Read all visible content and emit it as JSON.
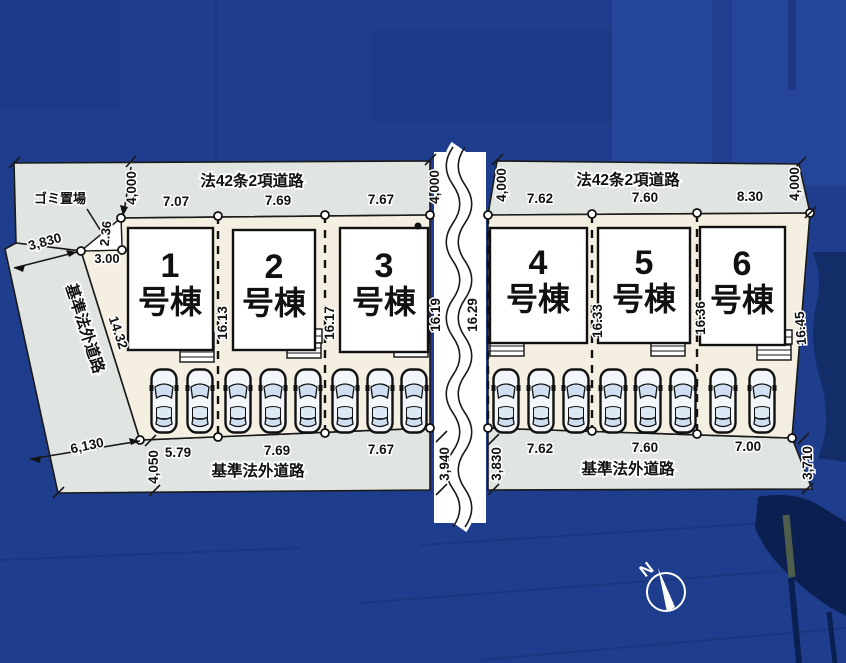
{
  "plan": {
    "roads": {
      "top_left": "法42条2項道路",
      "top_right": "法42条2項道路",
      "left": "基準法外道路",
      "bottom_left": "基準法外道路",
      "bottom_right": "基準法外道路"
    },
    "garbage": {
      "label": "ゴミ置場",
      "side_a": "2.36",
      "side_b": "3.00"
    },
    "lots": [
      {
        "no": "1",
        "suffix": "号棟",
        "top": "7.07",
        "bottom": "5.79"
      },
      {
        "no": "2",
        "suffix": "号棟",
        "top": "7.69",
        "bottom": "7.69"
      },
      {
        "no": "3",
        "suffix": "号棟",
        "top": "7.67",
        "bottom": "7.67"
      },
      {
        "no": "4",
        "suffix": "号棟",
        "top": "7.62",
        "bottom": "7.62"
      },
      {
        "no": "5",
        "suffix": "号棟",
        "top": "7.60",
        "bottom": "7.60"
      },
      {
        "no": "6",
        "suffix": "号棟",
        "top": "8.30",
        "bottom": "7.00"
      }
    ],
    "depth_dims": [
      "16.13",
      "16.17",
      "16.19",
      "16.29",
      "16.33",
      "16.36",
      "16.45"
    ],
    "road_width_dims": {
      "top_left_start": "4,000",
      "top_left_end": "4,000",
      "top_right_start": "4,000",
      "top_right_end": "4,000",
      "bottom_left_start": "4,050",
      "bottom_left_end": "3,940",
      "bottom_right_start": "3,830",
      "bottom_right_end": "3,710",
      "left_road_top": "3,830",
      "left_road_bottom": "6,130"
    },
    "boundary_dims": {
      "lot1_left": "14.32"
    },
    "compass": {
      "north": "N"
    }
  },
  "colors": {
    "background": "#1e3d8d",
    "road": "#e0e5e2",
    "ground": "#f5efe1",
    "building": "#ffffff",
    "line": "#1a1a1a"
  }
}
